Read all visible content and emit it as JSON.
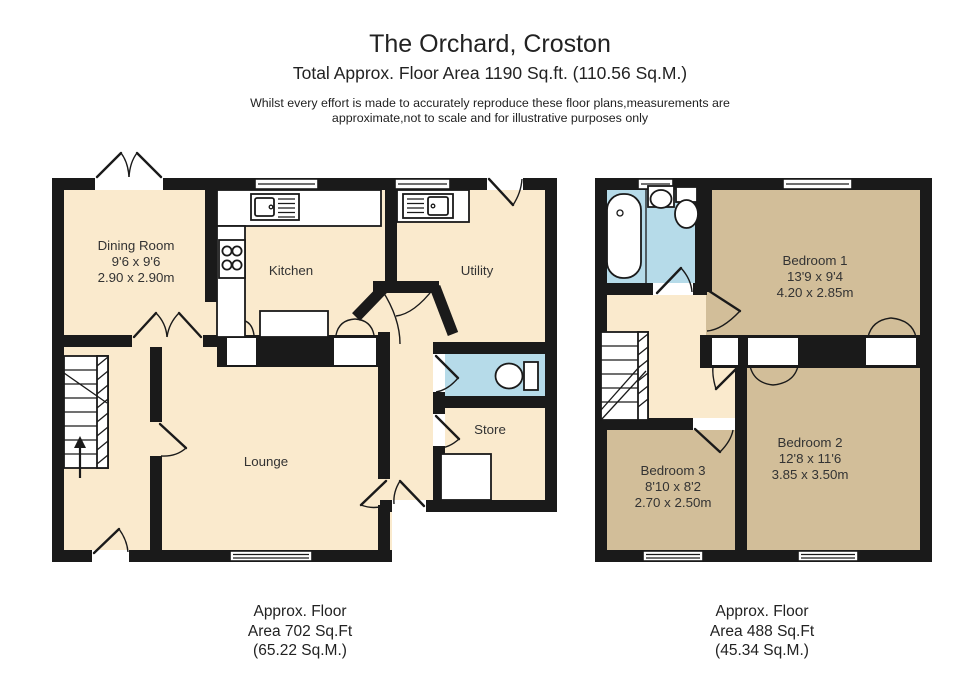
{
  "header": {
    "title": "The Orchard, Croston",
    "subtitle": "Total Approx. Floor Area 1190 Sq.ft. (110.56 Sq.M.)",
    "disclaimer_line1": "Whilst every effort is made to accurately reproduce these floor plans,measurements are",
    "disclaimer_line2": "approximate,not to scale and for illustrative purposes only"
  },
  "ground_floor": {
    "rooms": {
      "dining_room": {
        "name": "Dining Room",
        "imperial": "9'6 x 9'6",
        "metric": "2.90 x 2.90m"
      },
      "kitchen": {
        "name": "Kitchen"
      },
      "utility": {
        "name": "Utility"
      },
      "lounge": {
        "name": "Lounge"
      },
      "store": {
        "name": "Store"
      }
    },
    "area_label": {
      "line1": "Approx. Floor",
      "line2": "Area 702 Sq.Ft",
      "line3": "(65.22 Sq.M.)"
    }
  },
  "first_floor": {
    "rooms": {
      "bedroom1": {
        "name": "Bedroom 1",
        "imperial": "13'9 x 9'4",
        "metric": "4.20 x 2.85m"
      },
      "bedroom2": {
        "name": "Bedroom 2",
        "imperial": "12'8 x 11'6",
        "metric": "3.85 x 3.50m"
      },
      "bedroom3": {
        "name": "Bedroom 3",
        "imperial": "8'10 x 8'2",
        "metric": "2.70 x 2.50m"
      }
    },
    "area_label": {
      "line1": "Approx. Floor",
      "line2": "Area 488 Sq.Ft",
      "line3": "(45.34 Sq.M.)"
    }
  },
  "colors": {
    "room_fill": "#FAEACD",
    "bathroom_fill": "#B6DBE9",
    "bedroom_fill": "#D2BE99",
    "wall": "#1A1A1A",
    "background": "#FFFFFF"
  }
}
